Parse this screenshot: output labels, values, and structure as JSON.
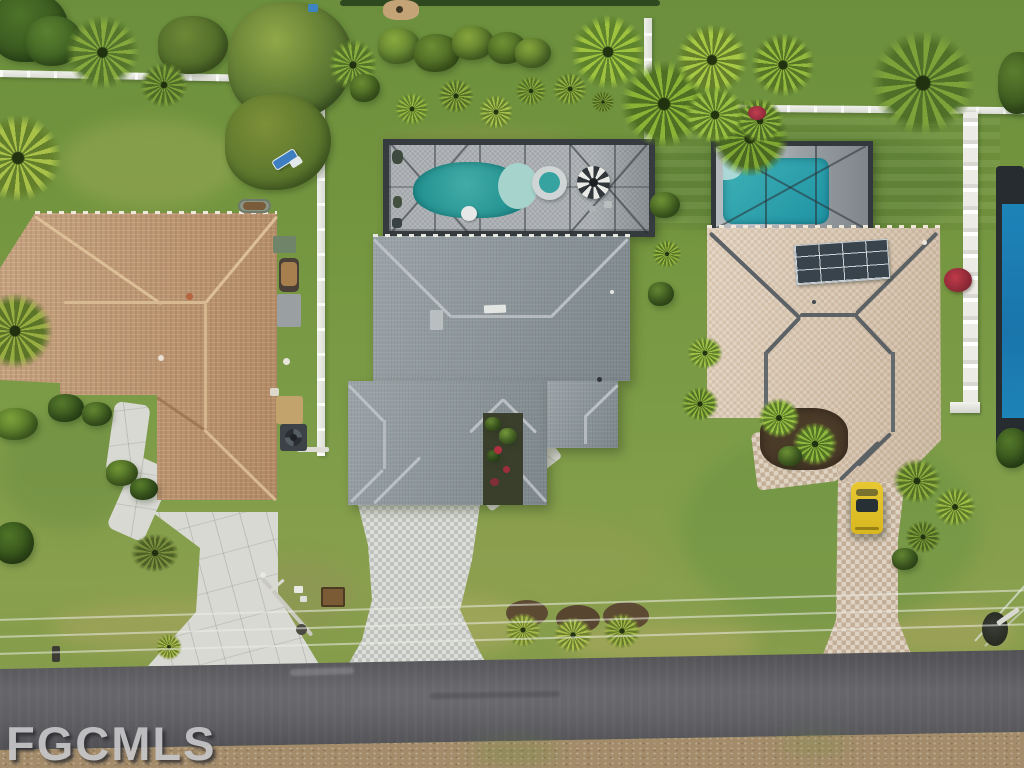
{
  "watermark": {
    "text": "FGCMLS"
  },
  "scene": {
    "type": "aerial-real-estate-photo",
    "objects": {
      "left_house": "brown shingle hip-roof house",
      "center_house": "gray shingle roof house with screened pool lanai",
      "center_pool": "freeform pool with spa and striped umbrella",
      "right_house": "tan roof house with rooftop solar panel array",
      "right_pool": "rectangular pool in screened enclosure",
      "car": "yellow car parked in paver driveway",
      "road": "asphalt street with overhead power lines",
      "fences": "white vinyl and lattice fences",
      "vegetation": "palm trees, shrubs and lawns"
    },
    "colors": {
      "pool_water": "#2aa0a4",
      "right_pool_water": "#2a9fb0",
      "left_roof": "#c09872",
      "center_roof": "#909a9e",
      "right_roof": "#d9c6ae",
      "lawn": "#7a9a48",
      "road": "#57575b",
      "car": "#e3c226",
      "solar_panel": "#39434c",
      "fence": "#efefec",
      "watermark_color": "#c6c6c8"
    }
  }
}
